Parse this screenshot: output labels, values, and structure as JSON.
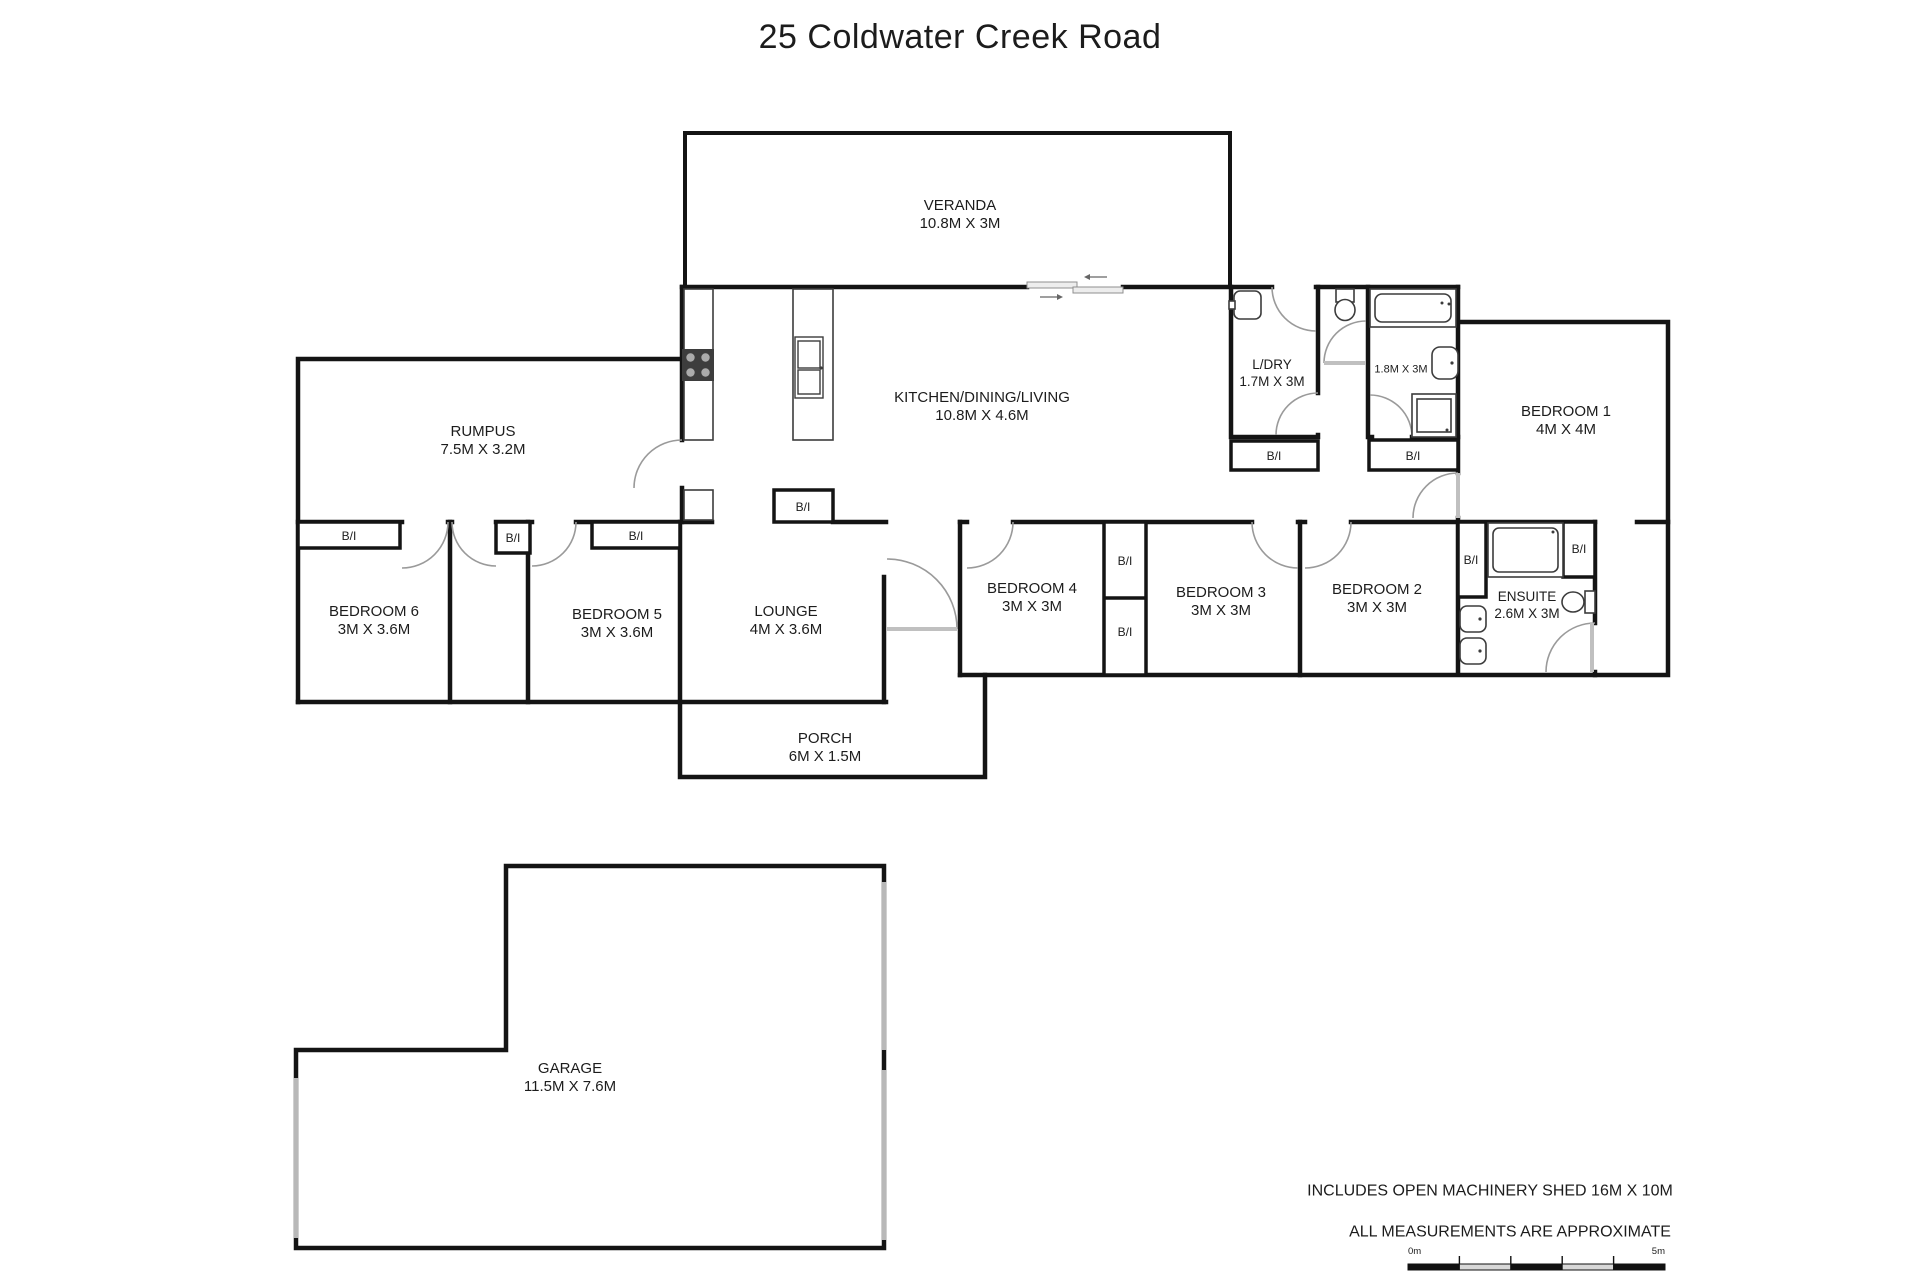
{
  "title": "25 Coldwater Creek Road",
  "rooms": {
    "veranda": {
      "name": "VERANDA",
      "dims": "10.8M X 3M"
    },
    "kitchen": {
      "name": "KITCHEN/DINING/LIVING",
      "dims": "10.8M X 4.6M"
    },
    "rumpus": {
      "name": "RUMPUS",
      "dims": "7.5M X 3.2M"
    },
    "laundry": {
      "name": "L/DRY",
      "dims": "1.7M X 3M"
    },
    "bathroom": {
      "name": "",
      "dims": "1.8M X 3M"
    },
    "bedroom1": {
      "name": "BEDROOM 1",
      "dims": "4M X 4M"
    },
    "bedroom2": {
      "name": "BEDROOM 2",
      "dims": "3M X 3M"
    },
    "bedroom3": {
      "name": "BEDROOM 3",
      "dims": "3M X 3M"
    },
    "bedroom4": {
      "name": "BEDROOM 4",
      "dims": "3M X 3M"
    },
    "bedroom5": {
      "name": "BEDROOM 5",
      "dims": "3M X 3.6M"
    },
    "bedroom6": {
      "name": "BEDROOM 6",
      "dims": "3M X 3.6M"
    },
    "ensuite": {
      "name": "ENSUITE",
      "dims": "2.6M X 3M"
    },
    "lounge": {
      "name": "LOUNGE",
      "dims": "4M X 3.6M"
    },
    "porch": {
      "name": "PORCH",
      "dims": "6M X 1.5M"
    },
    "garage": {
      "name": "GARAGE",
      "dims": "11.5M X 7.6M"
    }
  },
  "labels": {
    "built_in": "B/I"
  },
  "notes": {
    "line1": "INCLUDES OPEN MACHINERY SHED 16M X 10M",
    "line2": "ALL MEASUREMENTS ARE APPROXIMATE"
  },
  "scale_bar": {
    "start": "0m",
    "end": "5m"
  },
  "colors": {
    "wall": "#141414",
    "fixture": "#3c3c3c",
    "door": "#9a9a9a",
    "window": "#b8b8b8",
    "text": "#1c1c1c",
    "panel": "#c0c0c0"
  }
}
